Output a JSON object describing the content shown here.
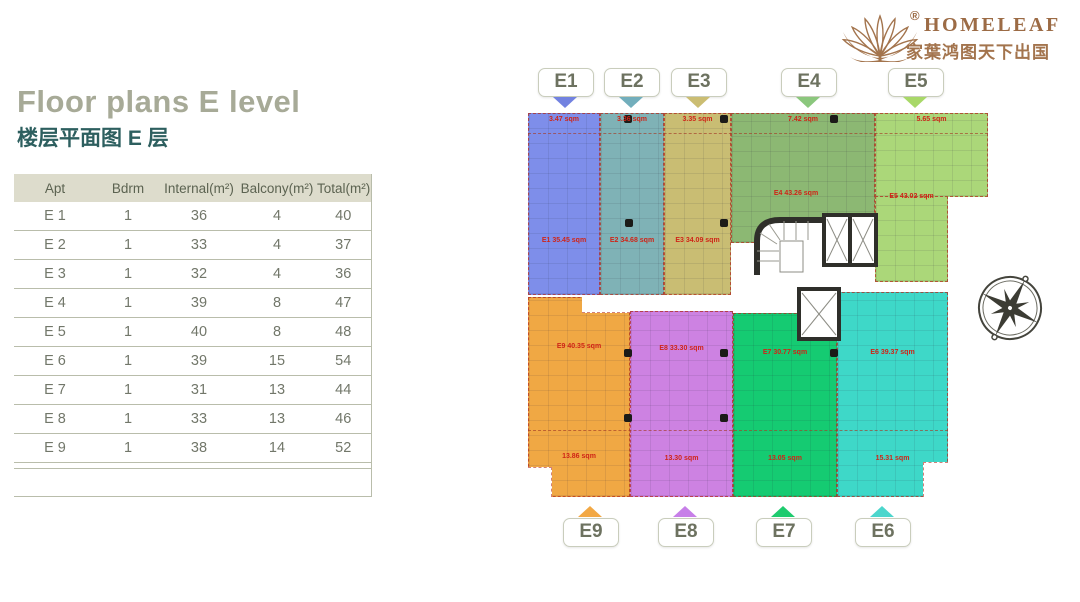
{
  "page": {
    "bg": "#ffffff"
  },
  "logo": {
    "brand": "HOMELEAF",
    "registered": "®",
    "tagline_cn": "家葉鸿图天下出国",
    "color": "#9c6b45"
  },
  "header": {
    "title": "Floor plans E level",
    "subtitle_cn": "楼层平面图 E 层",
    "title_color": "#a7aa97",
    "subtitle_color": "#2d5f5f"
  },
  "table": {
    "headers": [
      "Apt",
      "Bdrm",
      "Internal(m²)",
      "Balcony(m²)",
      "Total(m²)"
    ],
    "rows": [
      [
        "E 1",
        "1",
        "36",
        "4",
        "40"
      ],
      [
        "E 2",
        "1",
        "33",
        "4",
        "37"
      ],
      [
        "E 3",
        "1",
        "32",
        "4",
        "36"
      ],
      [
        "E 4",
        "1",
        "39",
        "8",
        "47"
      ],
      [
        "E 5",
        "1",
        "40",
        "8",
        "48"
      ],
      [
        "E 6",
        "1",
        "39",
        "15",
        "54"
      ],
      [
        "E 7",
        "1",
        "31",
        "13",
        "44"
      ],
      [
        "E 8",
        "1",
        "33",
        "13",
        "46"
      ],
      [
        "E 9",
        "1",
        "38",
        "14",
        "52"
      ]
    ],
    "header_bg": "#dddccc",
    "text_color": "#72776a"
  },
  "floorplan": {
    "area_unit": "sqm",
    "label_color": "#cf2417",
    "units": [
      {
        "id": "E1",
        "color": "#7e8eea",
        "area_label": "E1 35.45 sqm",
        "balcony_label": "3.47 sqm"
      },
      {
        "id": "E2",
        "color": "#7fb2b6",
        "area_label": "E2 34.68 sqm",
        "balcony_label": "3.36 sqm"
      },
      {
        "id": "E3",
        "color": "#c9bd73",
        "area_label": "E3 34.09 sqm",
        "balcony_label": "3.35 sqm"
      },
      {
        "id": "E4",
        "color": "#8cb873",
        "area_label": "E4 43.26 sqm",
        "balcony_label": "7.42 sqm"
      },
      {
        "id": "E5",
        "color": "#abd779",
        "area_label": "E5 43.02 sqm",
        "balcony_label": "5.65 sqm"
      },
      {
        "id": "E6",
        "color": "#3ed8c8",
        "area_label": "E6 39.37 sqm",
        "balcony_label": "15.31 sqm"
      },
      {
        "id": "E7",
        "color": "#15cb72",
        "area_label": "E7 30.77 sqm",
        "balcony_label": "13.05 sqm"
      },
      {
        "id": "E8",
        "color": "#cd82e2",
        "area_label": "E8 33.30 sqm",
        "balcony_label": "13.30 sqm"
      },
      {
        "id": "E9",
        "color": "#f0a844",
        "area_label": "E9 40.35 sqm",
        "balcony_label": "13.86 sqm"
      }
    ],
    "top_markers": [
      {
        "label": "E1",
        "arrow_color": "#7282e0"
      },
      {
        "label": "E2",
        "arrow_color": "#72aebc"
      },
      {
        "label": "E3",
        "arrow_color": "#cbbd72"
      },
      {
        "label": "E4",
        "arrow_color": "#8bc77d"
      },
      {
        "label": "E5",
        "arrow_color": "#a8d868"
      }
    ],
    "bottom_markers": [
      {
        "label": "E9",
        "arrow_color": "#f2a844"
      },
      {
        "label": "E8",
        "arrow_color": "#c77fe8"
      },
      {
        "label": "E7",
        "arrow_color": "#1ecb6e"
      },
      {
        "label": "E6",
        "arrow_color": "#4cd6cc"
      }
    ]
  }
}
